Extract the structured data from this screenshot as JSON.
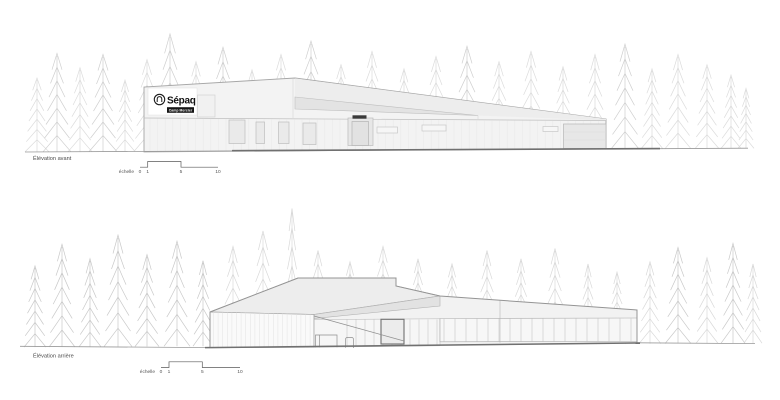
{
  "front_elevation": {
    "label": "Élévation avant",
    "sign": {
      "brand": "Sépaq",
      "site": "Camp Mercier"
    },
    "scale": {
      "label": "échelle",
      "ticks": [
        "0",
        "1",
        "5",
        "10"
      ]
    }
  },
  "rear_elevation": {
    "label": "Élévation arrière",
    "scale": {
      "label": "échelle",
      "ticks": [
        "0",
        "1",
        "5",
        "10"
      ]
    }
  },
  "colors": {
    "outline": "#9a9a9a",
    "ground_line": "#707070",
    "wall": "#f3f3f3",
    "roof_shade": "#e3e3e3",
    "sign_background": "#ffffff",
    "sign_bar": "#151515",
    "tree_light": "#dcdcdc",
    "tree_dark": "#c9c9c9"
  }
}
